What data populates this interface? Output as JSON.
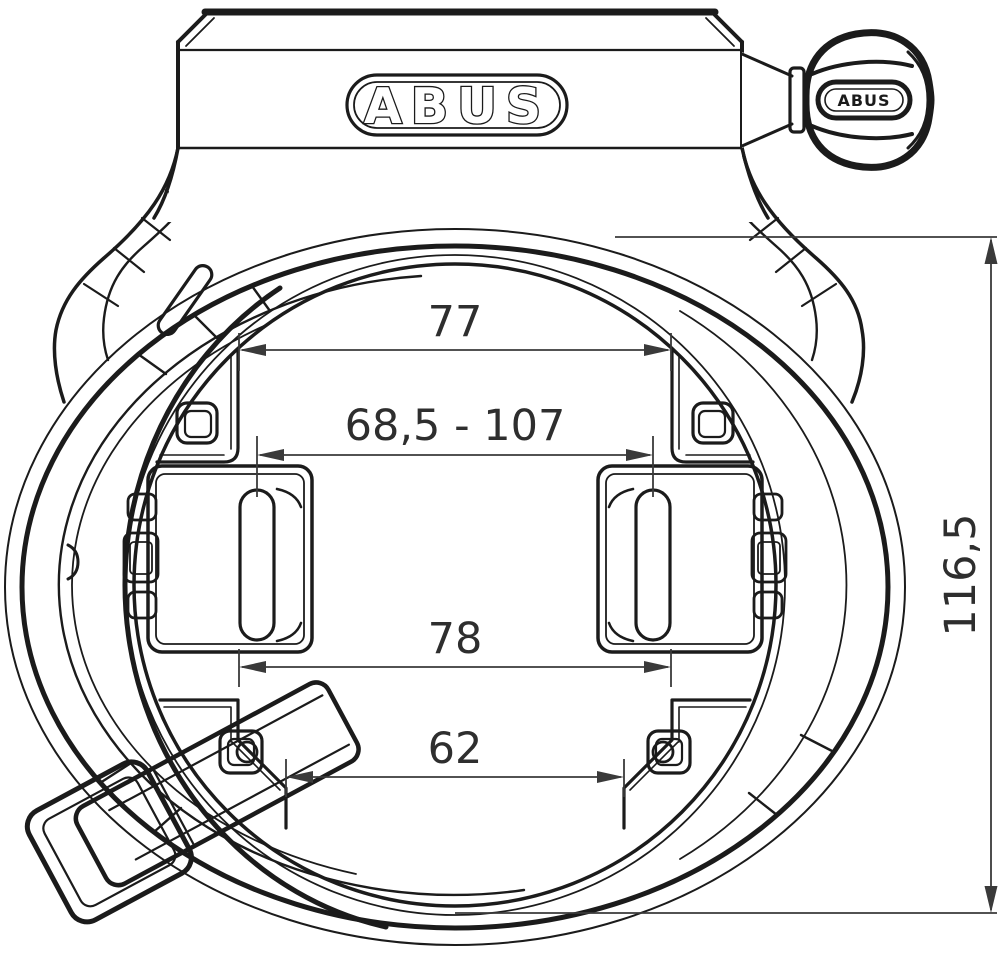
{
  "drawing": {
    "title": "frame-lock-technical-drawing",
    "brand_logo": "ABUS",
    "key_marking": "ABUS",
    "dimensions": {
      "upper_mount_width": "77",
      "adjustable_range": "68,5 - 107",
      "lower_mount_width": "78",
      "opening_width": "62",
      "overall_height": "116,5"
    },
    "colors": {
      "ink": "#1b1b1b",
      "dimension_ink": "#3a3a3a",
      "background": "#ffffff"
    }
  }
}
